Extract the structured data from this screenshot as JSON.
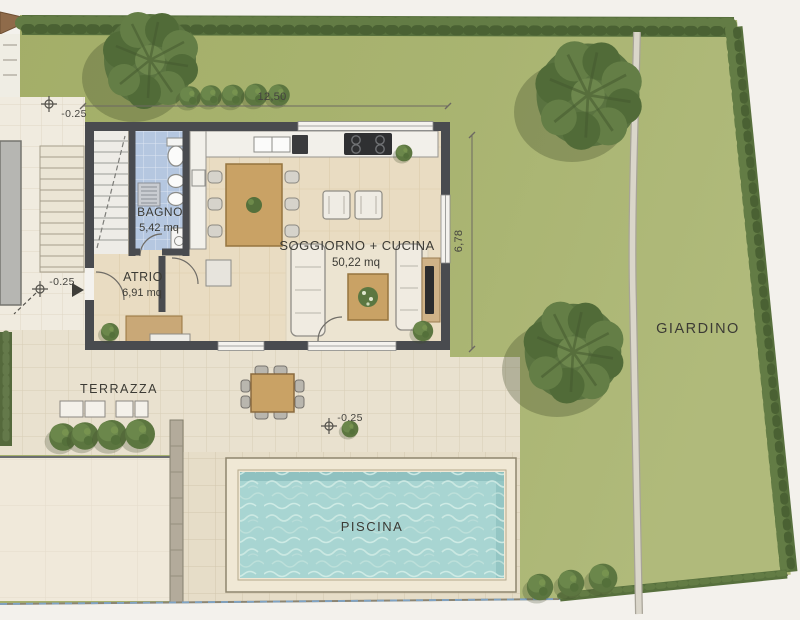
{
  "rooms": [
    {
      "label": "BAGNO",
      "area": "5,42 mq"
    },
    {
      "label": "ATRIO",
      "area": "6,91 mq"
    },
    {
      "label": "SOGGIORNO + CUCINA",
      "area": "50,22 mq"
    }
  ],
  "outdoor": {
    "terrace_label": "TERRAZZA",
    "pool_label": "PISCINA",
    "garden_label": "GIARDINO"
  },
  "dimensions": {
    "top_width": "12,50",
    "right_height": "6,78"
  },
  "level_markers": [
    {
      "value": "-0.25"
    },
    {
      "value": "-0.25"
    },
    {
      "value": "-0.25"
    }
  ],
  "colors": {
    "grass": "#a8b371",
    "hedge": "#57703d",
    "wall": "#494b4f",
    "water": "#a8d5d2",
    "wood_floor": "#e9dcc2",
    "patio_tile": "#e9e1cf",
    "bath_tile": "#b5c7e0"
  }
}
